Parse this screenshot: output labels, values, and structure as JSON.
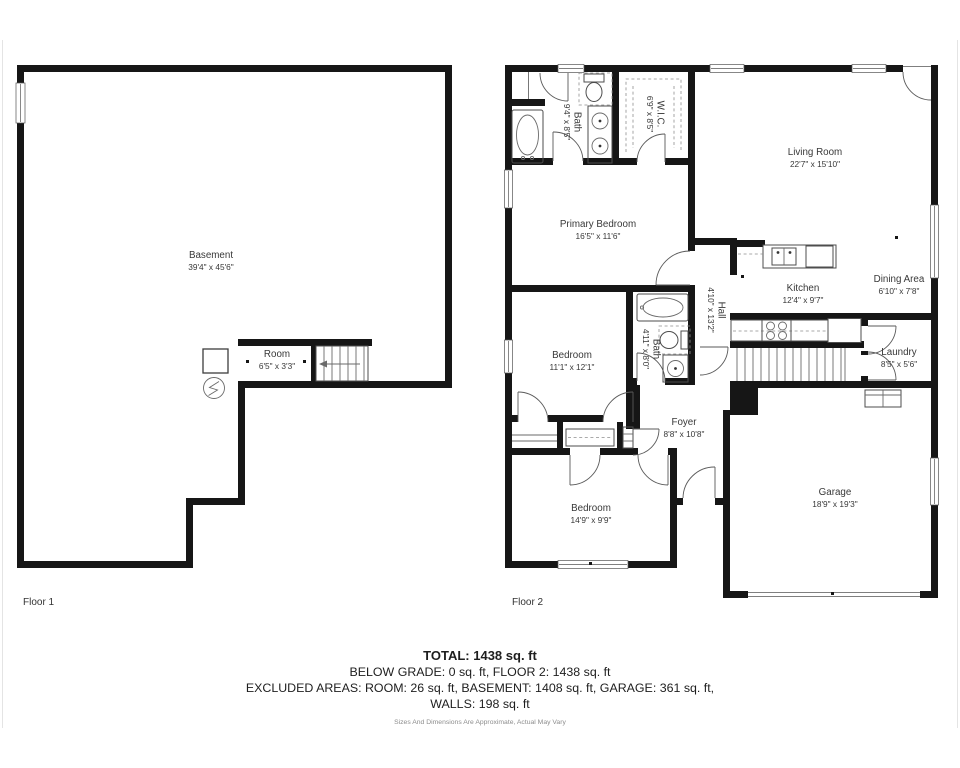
{
  "floor1": {
    "label": "Floor 1",
    "rooms": {
      "basement": {
        "name": "Basement",
        "dims": "39'4\" x 45'6\""
      },
      "room": {
        "name": "Room",
        "dims": "6'5\" x 3'3\""
      }
    }
  },
  "floor2": {
    "label": "Floor 2",
    "rooms": {
      "bath1": {
        "name": "Bath",
        "dims": "9'4\" x 8'5\""
      },
      "wic": {
        "name": "W.I.C.",
        "dims": "6'9\" x 8'5\""
      },
      "living": {
        "name": "Living Room",
        "dims": "22'7\" x 15'10\""
      },
      "primary": {
        "name": "Primary Bedroom",
        "dims": "16'5\" x 11'6\""
      },
      "kitchen": {
        "name": "Kitchen",
        "dims": "12'4\" x 9'7\""
      },
      "dining": {
        "name": "Dining Area",
        "dims": "6'10\" x 7'8\""
      },
      "hall": {
        "name": "Hall",
        "dims": "4'10\" x 13'2\""
      },
      "bedroom2": {
        "name": "Bedroom",
        "dims": "11'1\" x 12'1\""
      },
      "bath2": {
        "name": "Bath",
        "dims": "4'11\" x 8'0\""
      },
      "laundry": {
        "name": "Laundry",
        "dims": "8'5\" x 5'6\""
      },
      "foyer": {
        "name": "Foyer",
        "dims": "8'8\" x 10'8\""
      },
      "bedroom3": {
        "name": "Bedroom",
        "dims": "14'9\" x 9'9\""
      },
      "garage": {
        "name": "Garage",
        "dims": "18'9\" x 19'3\""
      }
    }
  },
  "summary": {
    "total": "TOTAL: 1438 sq. ft",
    "below_grade": "BELOW GRADE: 0 sq. ft, FLOOR 2: 1438 sq. ft",
    "excluded": "EXCLUDED AREAS: ROOM: 26 sq. ft, BASEMENT: 1408 sq. ft, GARAGE: 361 sq. ft,",
    "walls": "WALLS: 198 sq. ft",
    "disclaimer": "Sizes And Dimensions Are Approximate, Actual May Vary"
  },
  "colors": {
    "wall": "#161616",
    "fixture_line": "#4d4d4d",
    "text": "#383838"
  }
}
